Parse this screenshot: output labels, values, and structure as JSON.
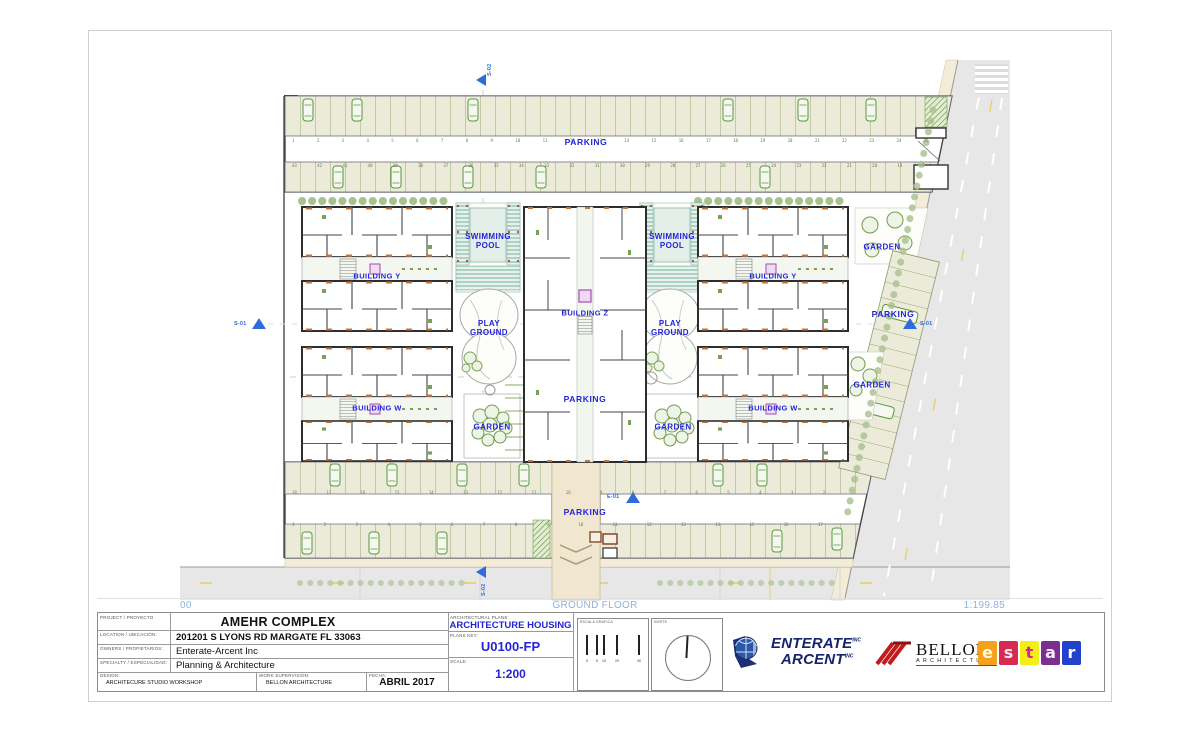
{
  "plan": {
    "labels": {
      "parking": "PARKING",
      "swimming_pool": "SWIMMING POOL",
      "building_y": "BUILDING Y",
      "building_z": "BUILDING Z",
      "building_w": "BUILDING W",
      "play_ground": "PLAY GROUND",
      "garden": "GARDEN"
    },
    "markers": {
      "s01": "S-01",
      "s02": "S-02",
      "e01": "E-01"
    },
    "stall_numbers": {
      "top_a": "1 2 3 4 5 6 7 8 9 10 11 12 13 14 15 16 17 18 19 20 21 22 23 24 25 26 27",
      "top_b": "43 42 41 40 39 38 37 36 35 34 33 32 31 30 29 28 27 26 25 24 23 22 21 20 19 18 17 16",
      "bottom_a": "18 17 16 15 14 13 12 11 10 9 8 7 6 5 4 3 2 1",
      "bottom_b": "1 2 3 4 5 6 7 8 9 10 11 12 13 14 15 16 17 18"
    },
    "strip": {
      "level": "00",
      "floor": "GROUND FLOOR",
      "ratio": "1:199.85"
    }
  },
  "titleblock": {
    "project_label": "PROJECT / PROYECTO",
    "project": "AMEHR COMPLEX",
    "location_label": "LOCATION / UBICACIÓN:",
    "location": "201201 S LYONS RD MARGATE FL 33063",
    "owners_label": "OWNERS / PROPIETARIOS:",
    "owners": "Enterate-Arcent Inc",
    "specialty_label": "SPECIALTY / ESPECIALIDAD:",
    "specialty": "Planning & Architecture",
    "design_label": "DESIGN:",
    "design": "ARCHITECURE STUDIO WORKSHOP",
    "supervision_label": "WORK SUPERVISION:",
    "supervision": "BELLON ARCHITECTURE",
    "date_label": "FECHA:",
    "date": "ABRIL 2017",
    "plans_label": "ARCHITECTURAL PLANS:",
    "plans": "ARCHITECTURE HOUSING",
    "key_label": "PLANS KEY:",
    "key": "U0100-FP",
    "scale_label": "SCALE:",
    "scale": "1:200",
    "escala_label": "ESCALA GRAFICA",
    "escala_ticks": [
      "0",
      "5",
      "10",
      "20",
      "40"
    ],
    "norte_label": "NORTE"
  },
  "logos": {
    "enterate": {
      "word1": "ENTERATE",
      "word2": "ARCENT",
      "suffix": "INC",
      "color": "#17246b"
    },
    "bellon": {
      "name": "BELLON",
      "sub": "ARCHITECTURE",
      "accent": "#c11b1e"
    },
    "estar": {
      "letters": [
        {
          "ch": "e",
          "style": "background:#f5a11c;color:#fffbdc"
        },
        {
          "ch": "s",
          "style": "background:#d62a52;color:#ffe9ee"
        },
        {
          "ch": "t",
          "style": "background:#f3ee18;color:#e0218a"
        },
        {
          "ch": "a",
          "style": "background:#7d2f8f;color:#f6ecff"
        },
        {
          "ch": "r",
          "style": "background:#2342cc;color:#ffffff"
        }
      ]
    }
  },
  "colors": {
    "label_blue": "#2424d8",
    "strip_blue": "#8fb2de",
    "stall_green": "#94aa72",
    "road_gray": "#e7e7e7",
    "pool_teal": "#74b0a4"
  }
}
